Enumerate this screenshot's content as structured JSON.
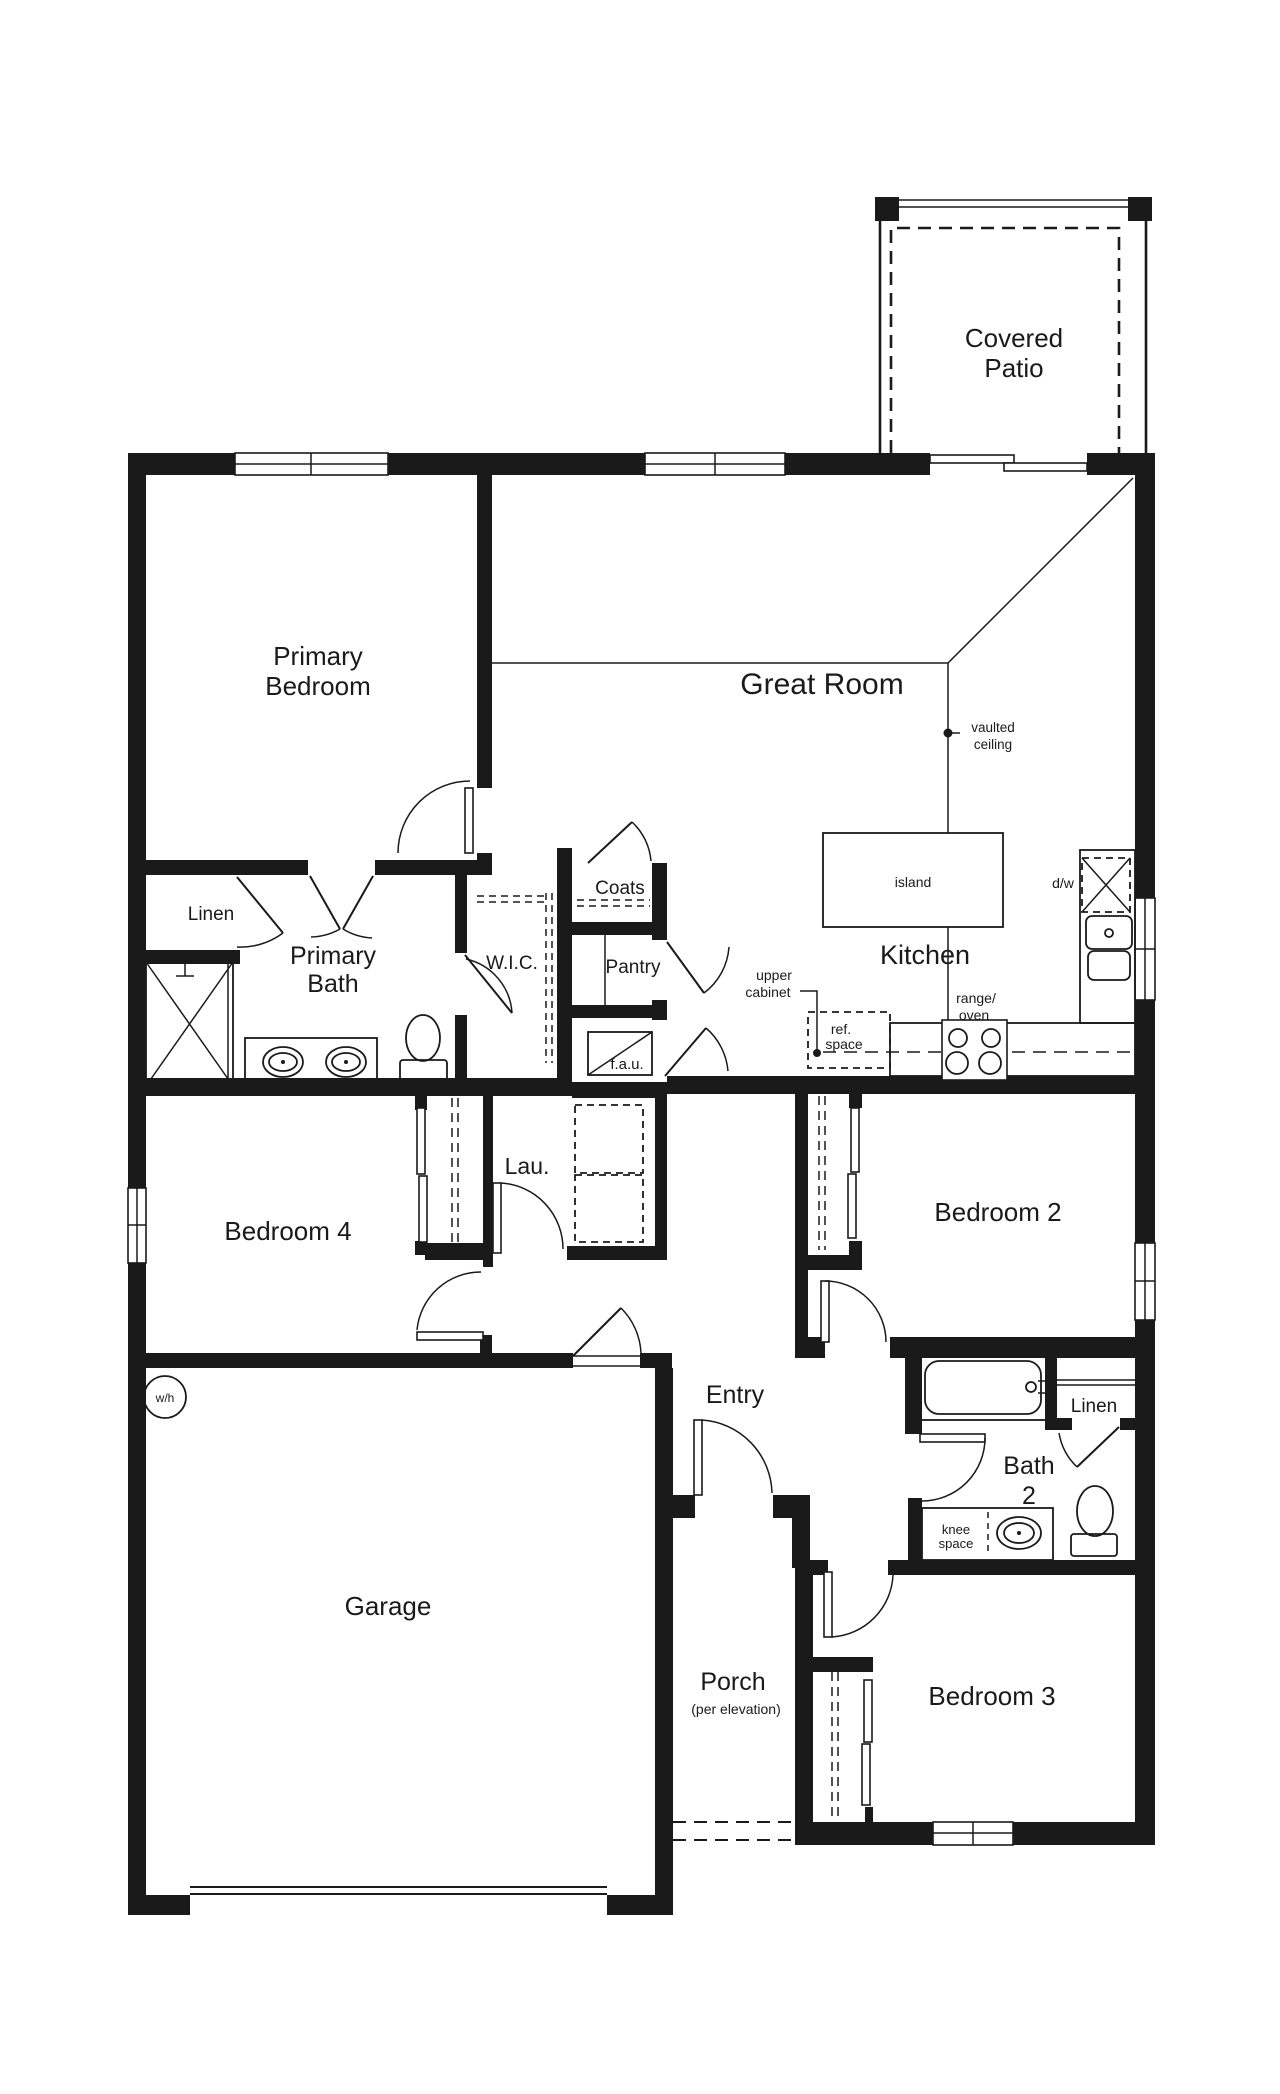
{
  "page": {
    "background": "#ffffff",
    "ink": "#1a1a1a"
  },
  "labels": {
    "covered_patio": {
      "line1": "Covered",
      "line2": "Patio"
    },
    "primary_bedroom": {
      "line1": "Primary",
      "line2": "Bedroom"
    },
    "great_room": {
      "text": "Great Room"
    },
    "vaulted_ceiling": {
      "line1": "vaulted",
      "line2": "ceiling"
    },
    "kitchen": {
      "text": "Kitchen"
    },
    "island": {
      "text": "island"
    },
    "dw": {
      "text": "d/w"
    },
    "upper_cabinet": {
      "line1": "upper",
      "line2": "cabinet"
    },
    "ref_space": {
      "line1": "ref.",
      "line2": "space"
    },
    "range_oven": {
      "line1": "range/",
      "line2": "oven"
    },
    "linen_primary": {
      "text": "Linen"
    },
    "primary_bath": {
      "line1": "Primary",
      "line2": "Bath"
    },
    "wic": {
      "text": "W.I.C."
    },
    "coats": {
      "text": "Coats"
    },
    "pantry": {
      "text": "Pantry"
    },
    "fau": {
      "text": "f.a.u."
    },
    "lau": {
      "text": "Lau."
    },
    "bedroom4": {
      "text": "Bedroom 4"
    },
    "bedroom2": {
      "text": "Bedroom 2"
    },
    "bedroom3": {
      "text": "Bedroom 3"
    },
    "bath2": {
      "line1": "Bath",
      "line2": "2"
    },
    "linen_bath2": {
      "text": "Linen"
    },
    "knee_space": {
      "line1": "knee",
      "line2": "space"
    },
    "wh": {
      "text": "w/h"
    },
    "garage": {
      "text": "Garage"
    },
    "entry": {
      "text": "Entry"
    },
    "porch": {
      "text": "Porch"
    },
    "porch_note": {
      "text": "(per elevation)"
    }
  }
}
